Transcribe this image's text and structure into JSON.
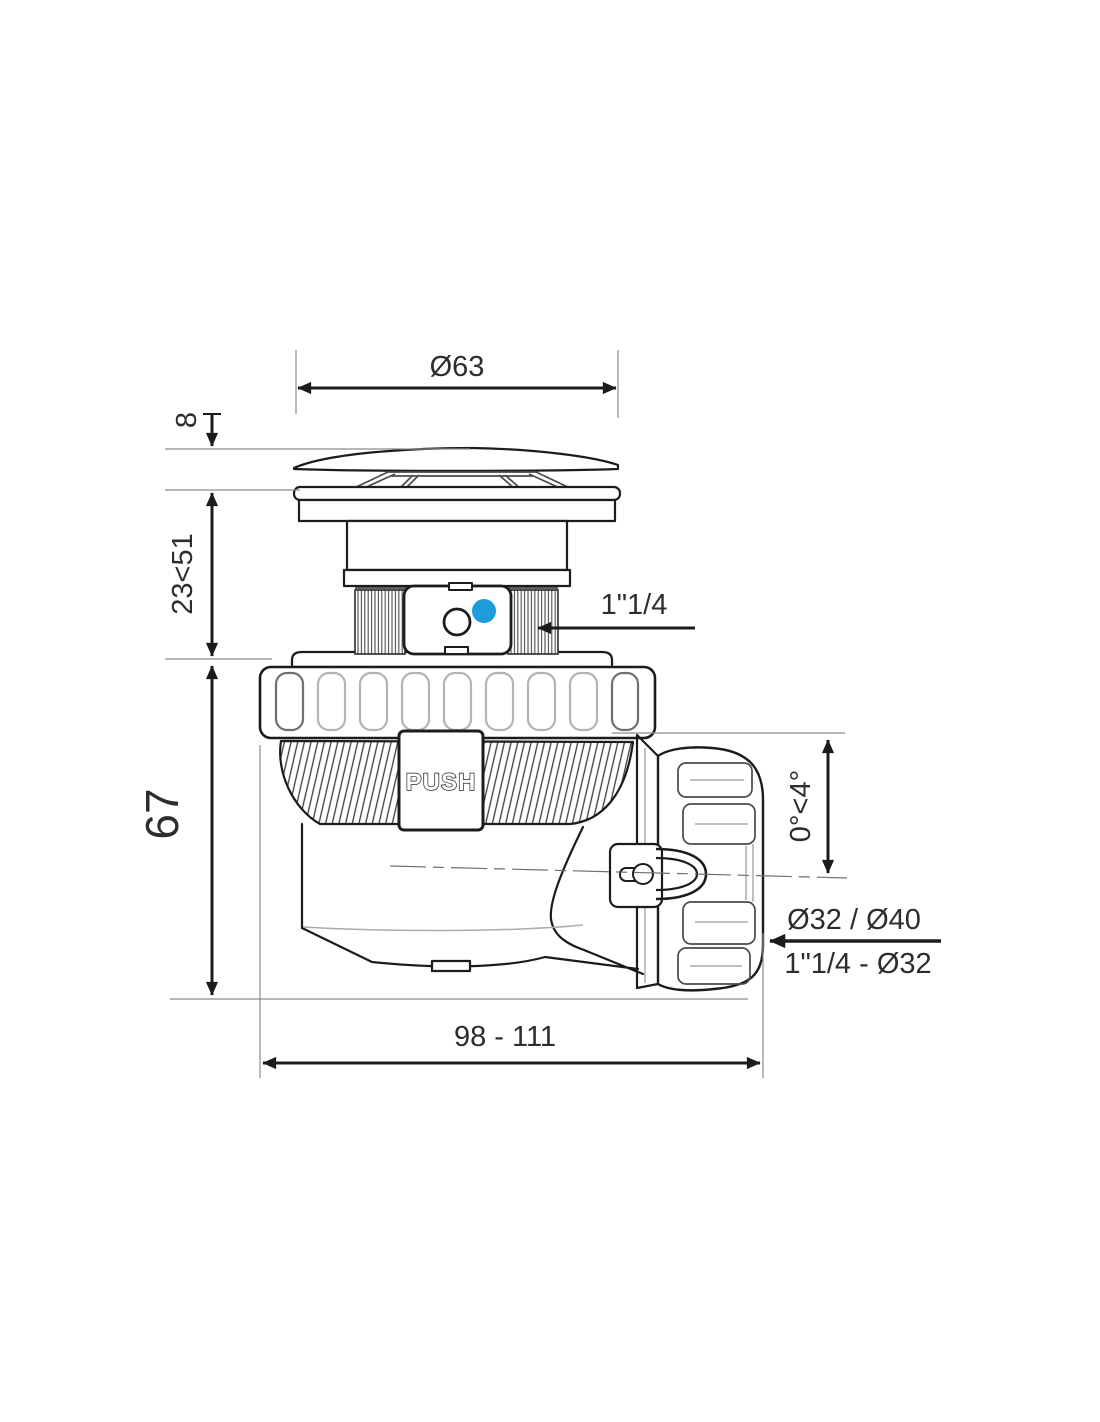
{
  "drawing": {
    "title": "push-waste-bottle-trap-technical-drawing",
    "colors": {
      "background": "#ffffff",
      "line": "#1c1c1c",
      "thin_line": "#8c8c8c",
      "accent_blue": "#1E9CD9"
    },
    "part_labels": {
      "push": "PUSH"
    },
    "dimensions": {
      "cap_diameter": "Ø63",
      "cap_height": "8",
      "adjustable_height": "23<51",
      "body_height": "67",
      "inlet_thread": "1\"1/4",
      "outlet_slope": "0°<4°",
      "outlet_diameters": "Ø32 / Ø40",
      "outlet_reduction": "1\"1/4 - Ø32",
      "overall_length": "98 - 111"
    }
  }
}
